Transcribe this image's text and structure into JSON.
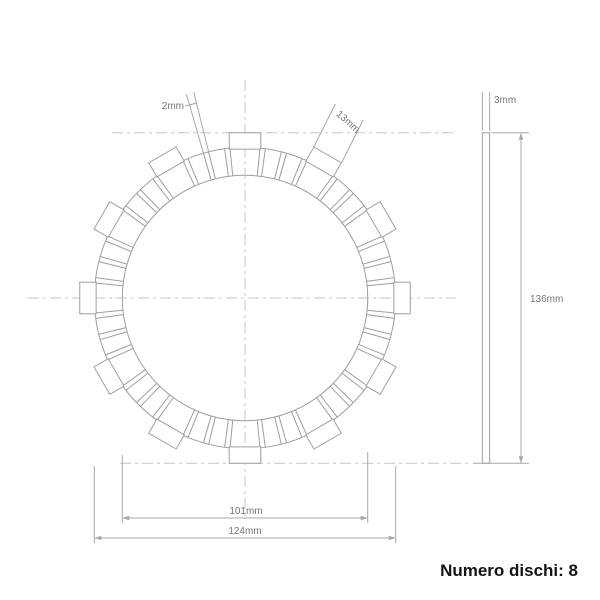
{
  "drawing": {
    "type": "clutch-friction-plate-technical-drawing",
    "front_view": {
      "center_x": 245,
      "center_y": 298,
      "scale_px_per_mm": 2.43,
      "inner_diameter_mm": 101,
      "friction_outer_diameter_mm": 124,
      "overall_diameter_mm": 136,
      "tab_count": 12,
      "tab_width_mm": 13,
      "groove_width_mm": 2,
      "grooves_per_sector": 3
    },
    "side_view": {
      "thickness_mm": 3,
      "height_mm": 136
    },
    "labels": {
      "groove": "2mm",
      "tab": "13mm",
      "thickness": "3mm",
      "overall": "136mm",
      "inner": "101mm",
      "outer": "124mm"
    },
    "colors": {
      "line": "#9e9e9e",
      "dashed": "#c6c6c6",
      "dim_line": "#a8a8a8",
      "dim_text": "#757575",
      "footer_text": "#141414",
      "background": "#ffffff"
    }
  },
  "footer": {
    "disc_count_label": "Numero dischi: 8"
  }
}
